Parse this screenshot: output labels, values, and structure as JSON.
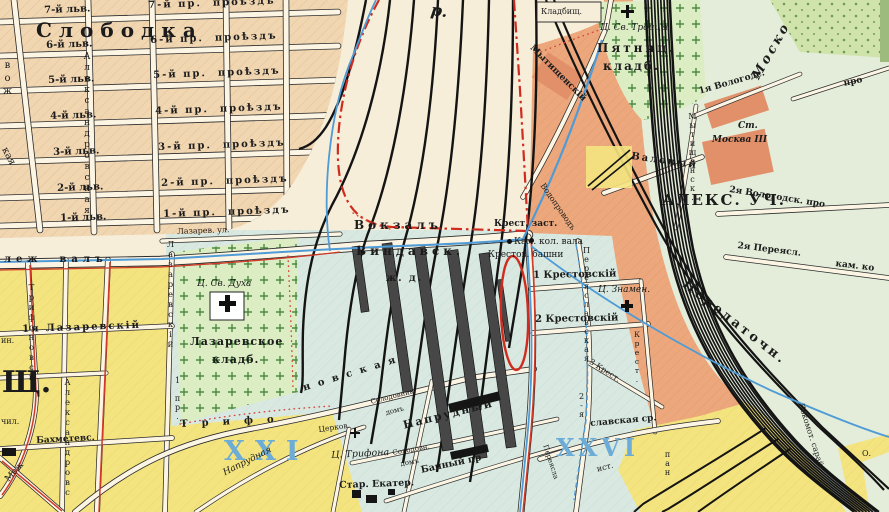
{
  "palette": {
    "base": "#f7eeda",
    "tan": "#f1d6b2",
    "salmon": "#eca87c",
    "salmonDark": "#e2906a",
    "blueRegion": "#d9e9e2",
    "eastGreen": "#e3edda",
    "yellow": "#f4e47f",
    "cemGreen": "#dcedc4",
    "parkGreen": "#cfe3ab",
    "streetWhite": "#fcf5e4",
    "railBlack": "#141414",
    "lineRed": "#d03a2a",
    "boundaryRed": "#cf2b1e",
    "waterBlue": "#4e9bd6",
    "precinctBlue": "#6cacd6",
    "ink": "#1b1b1b"
  },
  "map": {
    "labels": [
      {
        "id": "district-slobodka",
        "text": "Слободка",
        "x": 36,
        "y": 20,
        "size": 20,
        "ls": 7,
        "bold": true
      },
      {
        "id": "street-7-lv",
        "text": "7-й льв.",
        "x": 44,
        "y": 6,
        "size": 10,
        "bold": true,
        "rot": -2
      },
      {
        "id": "street-6-lv",
        "text": "6-й льв.",
        "x": 46,
        "y": 41,
        "size": 10,
        "bold": true,
        "rot": -2
      },
      {
        "id": "street-5-lv",
        "text": "5-й льв.",
        "x": 48,
        "y": 76,
        "size": 10,
        "bold": true,
        "rot": -2
      },
      {
        "id": "street-4-lv",
        "text": "4-й льв.",
        "x": 50,
        "y": 112,
        "size": 10,
        "bold": true,
        "rot": -2
      },
      {
        "id": "street-3-lv",
        "text": "3-й льв.",
        "x": 53,
        "y": 148,
        "size": 10,
        "bold": true,
        "rot": -2
      },
      {
        "id": "street-2-lv",
        "text": "2-й льв.",
        "x": 57,
        "y": 184,
        "size": 10,
        "bold": true,
        "rot": -2
      },
      {
        "id": "street-1-lv",
        "text": "1-й льв.",
        "x": 60,
        "y": 214,
        "size": 10,
        "bold": true,
        "rot": -2
      },
      {
        "id": "street-7-proezd",
        "text": "7-й пр.  проѣздъ",
        "x": 148,
        "y": 1,
        "size": 10,
        "bold": true,
        "rot": -2,
        "ls": 2
      },
      {
        "id": "street-6-proezd",
        "text": "6-й пр.  проѣздъ",
        "x": 150,
        "y": 36,
        "size": 10,
        "bold": true,
        "rot": -2,
        "ls": 2
      },
      {
        "id": "street-5-proezd",
        "text": "5-й пр.  проѣздъ",
        "x": 153,
        "y": 71,
        "size": 10,
        "bold": true,
        "rot": -2,
        "ls": 2
      },
      {
        "id": "street-4-proezd",
        "text": "4-й пр.  проѣздъ",
        "x": 155,
        "y": 107,
        "size": 10,
        "bold": true,
        "rot": -2,
        "ls": 2
      },
      {
        "id": "street-3-proezd",
        "text": "3-й пр.  проѣздъ",
        "x": 158,
        "y": 143,
        "size": 10,
        "bold": true,
        "rot": -2,
        "ls": 2
      },
      {
        "id": "street-2-proezd",
        "text": "2-й пр.  проѣздъ",
        "x": 161,
        "y": 179,
        "size": 10,
        "bold": true,
        "rot": -2,
        "ls": 2
      },
      {
        "id": "street-1-proezd",
        "text": "1-й пр.  проѣздъ",
        "x": 163,
        "y": 210,
        "size": 10,
        "bold": true,
        "rot": -2,
        "ls": 2
      },
      {
        "id": "street-aleksandrovskaya-north",
        "text": "Александровская",
        "x": 82,
        "y": 52,
        "size": 9,
        "mode": "v",
        "ls": 1
      },
      {
        "id": "street-fragment-vozh",
        "text": "вож",
        "x": 2,
        "y": 60,
        "size": 10,
        "mode": "v",
        "ls": 2
      },
      {
        "id": "street-fragment-kaya",
        "text": "кая",
        "x": 8,
        "y": 146,
        "size": 10,
        "rot": 62
      },
      {
        "id": "street-lazarev-ul",
        "text": "Лазарев. ул.",
        "x": 177,
        "y": 228,
        "size": 8,
        "rot": -2
      },
      {
        "id": "street-fragment-r",
        "text": "р.",
        "x": 432,
        "y": 2,
        "size": 16,
        "italic": true,
        "rot": 8,
        "bold": true
      },
      {
        "id": "station-vokzal",
        "text": "Вокзалъ",
        "x": 354,
        "y": 219,
        "size": 12,
        "ls": 4,
        "bold": true
      },
      {
        "id": "station-vindavsk",
        "text": "Виндавск.",
        "x": 356,
        "y": 245,
        "size": 12,
        "ls": 4,
        "bold": true
      },
      {
        "id": "station-zhd",
        "text": "ж. д.",
        "x": 386,
        "y": 274,
        "size": 10,
        "ls": 2,
        "bold": true
      },
      {
        "id": "landmark-krest-zastava",
        "text": "Крест. заст.",
        "x": 494,
        "y": 220,
        "size": 9,
        "bold": true
      },
      {
        "id": "landmark-kam-kol-vala",
        "text": "Кам. кол. вала",
        "x": 514,
        "y": 238,
        "size": 9
      },
      {
        "id": "landmark-krestov-bashni",
        "text": "Крестов. башни",
        "x": 488,
        "y": 251,
        "size": 9
      },
      {
        "id": "street-1-krestovsky",
        "text": "1 Крестовскій",
        "x": 533,
        "y": 271,
        "size": 10,
        "bold": true,
        "rot": -1
      },
      {
        "id": "street-2-krestovsky",
        "text": "2 Крестовскій",
        "x": 535,
        "y": 315,
        "size": 10,
        "bold": true,
        "rot": -1
      },
      {
        "id": "street-3-krest",
        "text": "3 Крест.",
        "x": 592,
        "y": 358,
        "size": 8,
        "rot": 33
      },
      {
        "id": "street-krest-vertical",
        "text": "Крест.",
        "x": 633,
        "y": 330,
        "size": 7.5,
        "mode": "v"
      },
      {
        "id": "street-pereyaslavskaya-vertical",
        "text": "Переяславская",
        "x": 582,
        "y": 246,
        "size": 8,
        "mode": "v"
      },
      {
        "id": "street-2ya-vertical",
        "text": "2-я",
        "x": 577,
        "y": 392,
        "size": 8,
        "mode": "v"
      },
      {
        "id": "church-znamen",
        "text": "Ц. Знамен.",
        "x": 598,
        "y": 286,
        "size": 9,
        "italic": true
      },
      {
        "id": "church-trinity",
        "text": "Ц. Св. Троицы",
        "x": 600,
        "y": 24,
        "size": 9,
        "italic": true
      },
      {
        "id": "cemetery-pyatnitskoye-line1",
        "text": "Пятниц.",
        "x": 597,
        "y": 42,
        "size": 12,
        "ls": 3,
        "bold": true
      },
      {
        "id": "cemetery-pyatnitskoye-line2",
        "text": "кладб.",
        "x": 603,
        "y": 60,
        "size": 12,
        "ls": 2,
        "bold": true
      },
      {
        "id": "landmark-kladbishch",
        "text": "Кладбищ.",
        "x": 541,
        "y": 8,
        "size": 8
      },
      {
        "id": "street-mytishchensky",
        "text": "Мытищенскій",
        "x": 534,
        "y": 44,
        "size": 9,
        "rot": 45,
        "bold": true
      },
      {
        "id": "street-mytishchensk-vertical",
        "text": "Мытищенск.",
        "x": 688,
        "y": 112,
        "size": 8,
        "mode": "v"
      },
      {
        "id": "street-valovy",
        "text": "Валовый",
        "x": 632,
        "y": 152,
        "size": 10,
        "rot": 8,
        "ls": 2,
        "bold": true
      },
      {
        "id": "street-1ya-vologods",
        "text": "1я Вологодс.",
        "x": 698,
        "y": 88,
        "size": 9,
        "rot": -16,
        "bold": true
      },
      {
        "id": "station-moskva3-line1",
        "text": "Ст.",
        "x": 738,
        "y": 122,
        "size": 9,
        "italic": true,
        "bold": true
      },
      {
        "id": "station-moskva3-line2",
        "text": "Москва III",
        "x": 712,
        "y": 136,
        "size": 9,
        "italic": true,
        "bold": true
      },
      {
        "id": "district-aleks-uch",
        "text": "АЛЕКС. УЧ.",
        "x": 662,
        "y": 193,
        "size": 15,
        "ls": 2,
        "bold": true
      },
      {
        "id": "street-2ya-vologodsk-pro",
        "text": "2я Вологодск. про",
        "x": 730,
        "y": 186,
        "size": 9,
        "rot": 9,
        "bold": true
      },
      {
        "id": "street-pro-fragment",
        "text": "про",
        "x": 843,
        "y": 80,
        "size": 9,
        "rot": -12,
        "bold": true
      },
      {
        "id": "street-2ya-pereyasl",
        "text": "2я Переясл.",
        "x": 738,
        "y": 242,
        "size": 9,
        "rot": 7,
        "bold": true
      },
      {
        "id": "street-kam-ko-fragment",
        "text": "кам. ко",
        "x": 836,
        "y": 260,
        "size": 9,
        "rot": 7,
        "bold": true
      },
      {
        "id": "railway-mosko",
        "text": "Моско",
        "x": 750,
        "y": 75,
        "size": 13,
        "rot": -60,
        "italic": true,
        "bold": true,
        "ls": 3
      },
      {
        "id": "railway-peredatochn",
        "text": "Передаточн.",
        "x": 688,
        "y": 278,
        "size": 13,
        "rot": 38,
        "ls": 3,
        "bold": true
      },
      {
        "id": "railway-lokomot-saray",
        "text": "Локомот. сарай",
        "x": 804,
        "y": 402,
        "size": 8,
        "rot": 72
      },
      {
        "id": "water-vodoprovod",
        "text": "Водопроводъ",
        "x": 545,
        "y": 182,
        "size": 8,
        "rot": 55
      },
      {
        "id": "street-lezh-val",
        "text": "леж  валъ",
        "x": 4,
        "y": 255,
        "size": 10,
        "ls": 5,
        "bold": true
      },
      {
        "id": "street-1ya-lazarevsky",
        "text": "1я Лазаревскій",
        "x": 22,
        "y": 325,
        "size": 10,
        "ls": 2,
        "bold": true,
        "rot": -2
      },
      {
        "id": "landmark-in",
        "text": "ин.",
        "x": 1,
        "y": 337,
        "size": 8
      },
      {
        "id": "district-shch",
        "text": "Щ.",
        "x": 2,
        "y": 368,
        "size": 30,
        "bold": true
      },
      {
        "id": "landmark-chil",
        "text": "чил.",
        "x": 1,
        "y": 418,
        "size": 8
      },
      {
        "id": "street-bakhmetevs",
        "text": "Бахметевс.",
        "x": 36,
        "y": 437,
        "size": 9,
        "rot": -3,
        "bold": true
      },
      {
        "id": "street-mezh",
        "text": "Меж",
        "x": 4,
        "y": 478,
        "size": 9,
        "rot": -48
      },
      {
        "id": "street-trifonovskaya-vertical",
        "text": "Трифоновск.",
        "x": 27,
        "y": 283,
        "size": 8.5,
        "mode": "v"
      },
      {
        "id": "street-aleksandrovskaya-south",
        "text": "Александровс",
        "x": 63,
        "y": 378,
        "size": 8.5,
        "mode": "v"
      },
      {
        "id": "street-lazarevsky-vertical",
        "text": "Лазаревскій",
        "x": 166,
        "y": 240,
        "size": 8.5,
        "mode": "v"
      },
      {
        "id": "street-1-pr-vertical",
        "text": "1 пр.",
        "x": 173,
        "y": 376,
        "size": 8,
        "mode": "v"
      },
      {
        "id": "church-svyatogo-dukha",
        "text": "Ц. Св. Духа",
        "x": 197,
        "y": 280,
        "size": 9,
        "italic": true
      },
      {
        "id": "cemetery-lazarevskoye-line1",
        "text": "Лазаревское",
        "x": 190,
        "y": 336,
        "size": 11,
        "ls": 1,
        "bold": true
      },
      {
        "id": "cemetery-lazarevskoye-line2",
        "text": "кладб.",
        "x": 212,
        "y": 354,
        "size": 11,
        "ls": 1,
        "bold": true
      },
      {
        "id": "precinct-xxi",
        "text": "XXI",
        "x": 224,
        "y": 438,
        "size": 27,
        "ls": 10,
        "bold": true,
        "color": "#6cacd6"
      },
      {
        "id": "precinct-xxvi",
        "text": "XXVI",
        "x": 556,
        "y": 436,
        "size": 24,
        "ls": 4,
        "bold": true,
        "color": "#6cacd6"
      },
      {
        "id": "street-trifonovskaya-part1",
        "text": "Трифо",
        "x": 180,
        "y": 420,
        "size": 10,
        "ls": 14,
        "rot": -3,
        "bold": true
      },
      {
        "id": "street-trifonovskaya-part2",
        "text": "новская",
        "x": 302,
        "y": 384,
        "size": 10,
        "ls": 8,
        "rot": -17,
        "bold": true
      },
      {
        "id": "street-naprudnaya",
        "text": "Напрудная",
        "x": 222,
        "y": 470,
        "size": 9,
        "italic": true,
        "rot": -27
      },
      {
        "id": "church-tserkov",
        "text": "Церков.",
        "x": 318,
        "y": 426,
        "size": 7.5,
        "rot": -8
      },
      {
        "id": "church-trifona",
        "text": "Ц. Трифона",
        "x": 331,
        "y": 451,
        "size": 9.5,
        "italic": true,
        "rot": -3
      },
      {
        "id": "landmark-star-ekater",
        "text": "Стар. Екатер.",
        "x": 339,
        "y": 481,
        "size": 9.5,
        "rot": -2,
        "bold": true
      },
      {
        "id": "building-solodovnik-line1",
        "text": "Солодовник.",
        "x": 370,
        "y": 399,
        "size": 7,
        "rot": -14
      },
      {
        "id": "building-solodovnik-line2",
        "text": "домъ",
        "x": 385,
        "y": 410,
        "size": 7,
        "rot": -14
      },
      {
        "id": "street-naprudny",
        "text": "Напрудный",
        "x": 402,
        "y": 420,
        "size": 11,
        "ls": 2,
        "rot": -14,
        "bold": true
      },
      {
        "id": "building-solodovn-line1",
        "text": "Солодовн.",
        "x": 392,
        "y": 450,
        "size": 7,
        "rot": -10
      },
      {
        "id": "building-solodovn-line2",
        "text": "домъ",
        "x": 400,
        "y": 461,
        "size": 7,
        "rot": -10
      },
      {
        "id": "street-banny-pr",
        "text": "Банный пр",
        "x": 420,
        "y": 466,
        "size": 9.5,
        "rot": -12,
        "bold": true
      },
      {
        "id": "street-pereyaslavskaya-sr",
        "text": "славская ср.",
        "x": 590,
        "y": 420,
        "size": 9,
        "rot": -5,
        "bold": true
      },
      {
        "id": "street-pereyasla-small",
        "text": "Переясла",
        "x": 548,
        "y": 444,
        "size": 7,
        "rot": 72
      },
      {
        "id": "street-ist-fragment",
        "text": "ист.",
        "x": 596,
        "y": 466,
        "size": 8,
        "rot": -15
      },
      {
        "id": "street-pan-vertical",
        "text": "пан",
        "x": 663,
        "y": 450,
        "size": 8,
        "mode": "v"
      },
      {
        "id": "landmark-o",
        "text": "О.",
        "x": 862,
        "y": 450,
        "size": 8
      }
    ],
    "landmark_icons": [
      {
        "id": "church-cross-icon-trinity",
        "x": 621,
        "y": 5,
        "size": 13
      },
      {
        "id": "church-cross-icon-dukha",
        "x": 219,
        "y": 295,
        "size": 17
      },
      {
        "id": "church-cross-icon-znamen",
        "x": 621,
        "y": 300,
        "size": 12
      },
      {
        "id": "church-cross-icon-trifona",
        "x": 350,
        "y": 428,
        "size": 10
      }
    ],
    "markers": [
      {
        "id": "zastava-tower-dot-west",
        "x": 509,
        "y": 241,
        "r": 2.5
      },
      {
        "id": "zastava-tower-dot-east",
        "x": 531,
        "y": 240,
        "r": 2.5
      }
    ]
  }
}
